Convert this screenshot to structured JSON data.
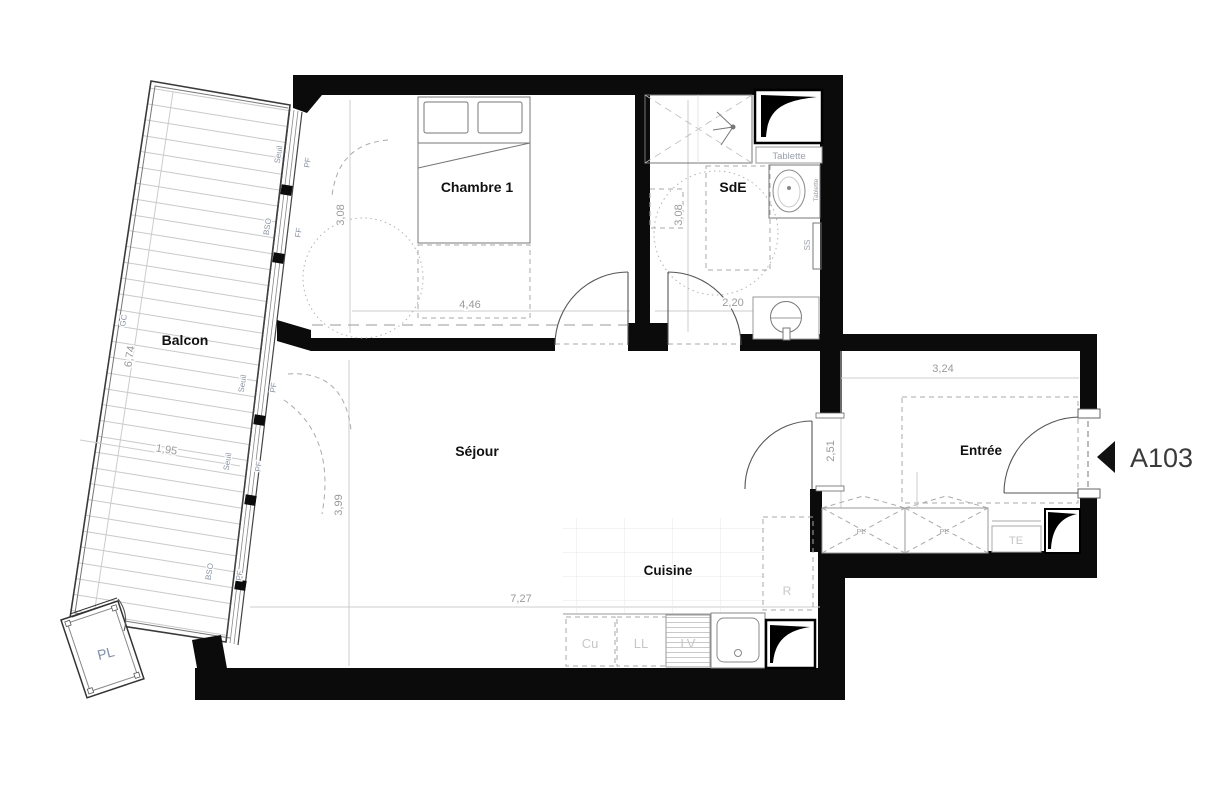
{
  "plan": {
    "unit_label": "A103",
    "rooms": {
      "chambre": "Chambre 1",
      "sde": "SdE",
      "sejour": "Séjour",
      "cuisine": "Cuisine",
      "entree": "Entrée",
      "balcon": "Balcon",
      "placard_balcon": "PL"
    },
    "dims": {
      "chambre_l": "4,46",
      "chambre_w": "3,08",
      "sde_l": "3,08",
      "sde_w": "2,20",
      "sejour_l": "7,27",
      "sejour_w": "3,99",
      "entree_l": "3,24",
      "entree_w": "2,51",
      "balcon_l": "6,74",
      "balcon_w": "1,95"
    },
    "facade_labels": [
      "Seuil",
      "PF",
      "BSO",
      "FF",
      "Seuil",
      "PF",
      "Seuil",
      "PF",
      "BSO",
      "PF",
      "GC"
    ],
    "equip": {
      "tablette": "Tablette",
      "tablette_side": "Tablette",
      "ss": "SS",
      "te": "TE",
      "cu": "Cu",
      "ll": "LL",
      "lv": "LV",
      "frigo": "R",
      "closet_pl": "PL"
    }
  }
}
